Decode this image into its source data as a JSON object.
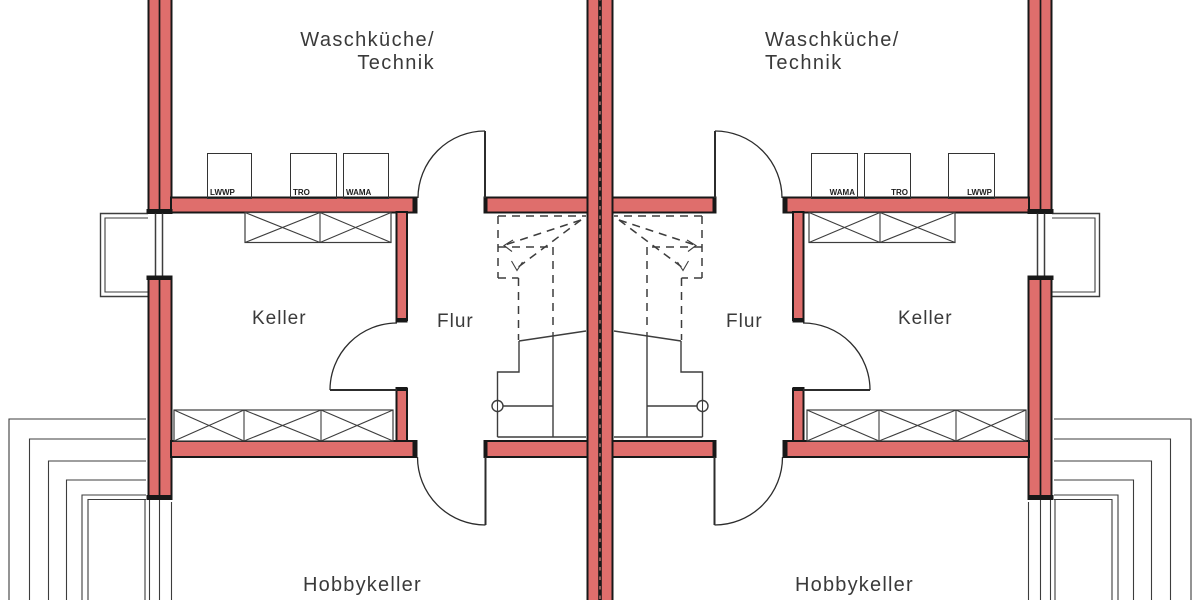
{
  "title": "Kellergeschoss Doppelhaus Grundriss",
  "colors": {
    "wall_fill": "#df6e6c",
    "wall_outline": "#181818",
    "line": "#3d3d3d",
    "text": "#3a3a3a",
    "background": "#ffffff"
  },
  "plan": {
    "left_unit": {
      "laundry_room_line1": "Waschküche/",
      "laundry_room_line2": "Technik",
      "keller_label": "Keller",
      "flur_label": "Flur",
      "hobbykeller_label": "Hobbykeller",
      "appliances": [
        {
          "label": "LWWP"
        },
        {
          "label": "TRO"
        },
        {
          "label": "WAMA"
        }
      ]
    },
    "right_unit": {
      "laundry_room_line1": "Waschküche/",
      "laundry_room_line2": "Technik",
      "keller_label": "Keller",
      "flur_label": "Flur",
      "hobbykeller_label": "Hobbykeller",
      "appliances": [
        {
          "label": "WAMA"
        },
        {
          "label": "TRO"
        },
        {
          "label": "LWWP"
        }
      ]
    }
  }
}
